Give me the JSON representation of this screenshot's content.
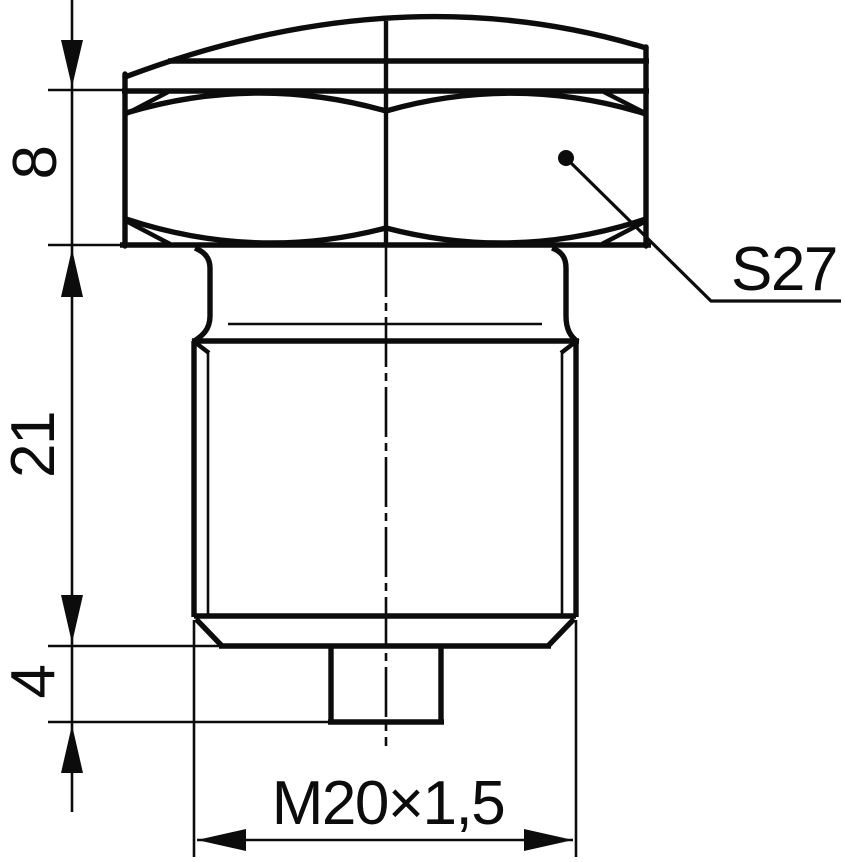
{
  "drawing": {
    "kind": "technical-drawing",
    "subject": "hex-head-threaded-plug-side-view",
    "colors": {
      "ink": "#0c0c0c",
      "paper": "#ffffff"
    },
    "labels": {
      "dim_head_height": "8",
      "dim_body_length": "21",
      "dim_tip_length": "4",
      "wrench_size": "S27",
      "thread_spec": "M20×1,5"
    }
  }
}
